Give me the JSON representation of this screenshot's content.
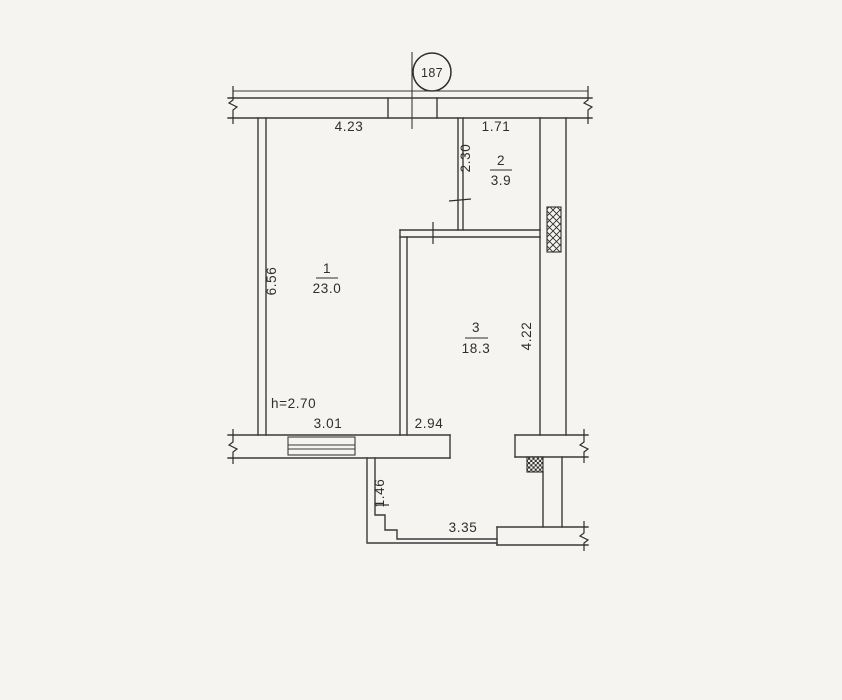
{
  "canvas": {
    "background": "#f6f4f0",
    "line_color": "#3a3a3a",
    "text_color": "#2e2e2e"
  },
  "plan": {
    "apartment_badge": "187",
    "rooms": [
      {
        "number": "1",
        "area": "23.0"
      },
      {
        "number": "2",
        "area": "3.9"
      },
      {
        "number": "3",
        "area": "18.3"
      }
    ],
    "labels": {
      "ceiling_height": "h=2.70"
    },
    "dimensions": {
      "top_left": "4.23",
      "top_right": "1.71",
      "hall_depth": "2.30",
      "left_side": "6.56",
      "right_side": "4.22",
      "window_span": "3.01",
      "room3_bottom": "2.94",
      "balcony_side": "1.46",
      "balcony_front": "3.35"
    }
  }
}
